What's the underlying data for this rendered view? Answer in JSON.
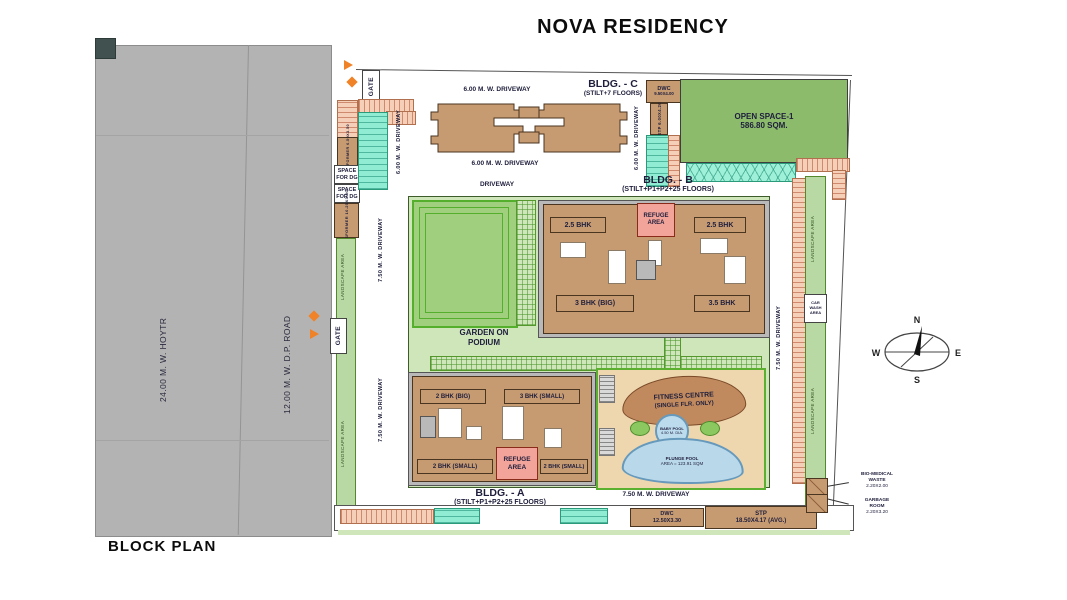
{
  "title": "NOVA RESIDENCY",
  "footer": {
    "plan_label": "BLOCK PLAN"
  },
  "roads": {
    "main_road": "24.00 M. W. HOYTR",
    "dp_road": "12.00 M. W. D.P. ROAD"
  },
  "gate": {
    "label": "GATE"
  },
  "compass": {
    "n": "N",
    "s": "S",
    "e": "E",
    "w": "W"
  },
  "buildings": {
    "c": {
      "name": "BLDG. - C",
      "floors": "(STILT+7 FLOORS)"
    },
    "b": {
      "name": "BLDG. - B",
      "floors": "(STILT+P1+P2+25 FLOORS)",
      "unit_top_left": "2.5 BHK",
      "unit_top_right": "2.5 BHK",
      "unit_bottom_left": "3 BHK (BIG)",
      "unit_bottom_right": "3.5 BHK",
      "refuge_line1": "REFUGE",
      "refuge_line2": "AREA"
    },
    "a": {
      "name": "BLDG. - A",
      "floors": "(STILT+P1+P2+25 FLOORS)",
      "unit_top_left": "2 BHK (BIG)",
      "unit_top_right": "3 BHK (SMALL)",
      "unit_bottom_left": "2 BHK (SMALL)",
      "unit_bottom_right": "2 BHK (SMALL)",
      "refuge_line1": "REFUGE",
      "refuge_line2": "AREA"
    }
  },
  "areas": {
    "open_space_name": "OPEN SPACE-1",
    "open_space_size": "586.80 SQM.",
    "garden_line1": "GARDEN ON",
    "garden_line2": "PODIUM",
    "landscape": "LANDSCAPE AREA",
    "fitness_line1": "FITNESS CENTRE",
    "fitness_line2": "(SINGLE FLR. ONLY)",
    "baby_pool_line1": "BABY POOL",
    "baby_pool_line2": "4.50 M. DIA.",
    "plunge_line1": "PLUNGE POOL",
    "plunge_line2": "AREA = 123.91 SQM",
    "car_wash_line1": "CAR",
    "car_wash_line2": "WASH",
    "car_wash_line3": "AREA"
  },
  "driveways": {
    "d600": "6.00 M. W. DRIVEWAY",
    "d750": "7.50 M. W. DRIVEWAY",
    "generic": "DRIVEWAY"
  },
  "utilities": {
    "dwc_top_name": "DWC",
    "dwc_top_dim": "9.50X4.00",
    "stp_top": "STP 6.00X4.20",
    "transformer_small": "TRANSFORMER 6.50X3.50",
    "transformer_big": "TRANSFORMER 10.25X3.50",
    "space_for_dg_line1": "SPACE",
    "space_for_dg_line2": "FOR DG",
    "dwc_bottom_name": "DWC",
    "dwc_bottom_dim": "12.50X3.30",
    "stp_bottom_name": "STP",
    "stp_bottom_dim": "18.50X4.17 (AVG.)",
    "biomedical_line1": "BIO-MEDICAL",
    "biomedical_line2": "WASTE",
    "biomedical_dim": "2.20X2.00",
    "garbage_line1": "GARBAGE",
    "garbage_line2": "ROOM",
    "garbage_dim": "2.20X3.20"
  },
  "colors": {
    "road": "#b3b3b3",
    "building_tan": "#c79b72",
    "podium_green": "#cfe5ba",
    "lawn_green": "#a0d07e",
    "open_space_green": "#8cbb6c",
    "parking_mint": "#90ecd2",
    "parking_salmon": "#f6cfb8",
    "refuge_pink": "#f2a49a",
    "pool_blue": "#b9d9ea",
    "gate_orange": "#f08228"
  }
}
